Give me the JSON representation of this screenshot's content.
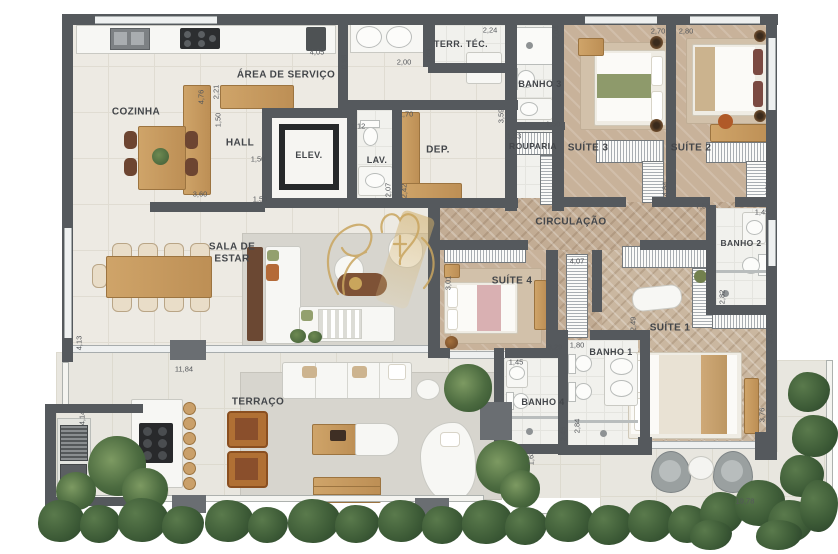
{
  "title": "Apartment floor plan",
  "rooms": {
    "cozinha": "COZINHA",
    "area_servico": "ÁREA DE SERVIÇO",
    "hall": "HALL",
    "elev": "ELEV.",
    "lav": "LAV.",
    "dep": "DEP.",
    "terr_tec": "TERR. TÉC.",
    "banho3": "BANHO 3",
    "rouparia": "ROUPARIA",
    "suite3": "SUÍTE 3",
    "suite2": "SUÍTE 2",
    "circulacao": "CIRCULAÇÃO",
    "banho2": "BANHO 2",
    "suite4": "SUÍTE 4",
    "suite1": "SUÍTE 1",
    "banho1": "BANHO 1",
    "banho4": "BANHO 4",
    "sala_line1": "SALA DE",
    "sala_line2": "ESTAR",
    "terraco": "TERRAÇO"
  },
  "dims": [
    "4,05",
    "0,98",
    "2,00",
    "1,03",
    "2,24",
    "2,04",
    "2,70",
    "2,80",
    "4,76",
    "2,21",
    "1,50",
    "1,50",
    "1,50",
    "3,60",
    "1,12",
    "1,70",
    "2,07",
    "2,42",
    "3,59",
    "1,50",
    "1,53",
    "4,84",
    "4,84",
    "7,56",
    "1,45",
    "2,82",
    "3,53",
    "3,76",
    "2,49",
    "4,07",
    "3,01",
    "3,29",
    "1,45",
    "1,80",
    "2,45",
    "2,84",
    "1,63",
    "19,78",
    "4,13",
    "11,84",
    "4,14"
  ],
  "colors": {
    "wall": "#55595d",
    "floor_tile": "#edeae3",
    "herringbone": "#c2ac94",
    "suite_floor": "#c8b29a",
    "wood": "#c79e63",
    "accent_gold": "#c9a55c",
    "greenery": "#3c5a36",
    "rug_gray": "#d7d5ce"
  }
}
